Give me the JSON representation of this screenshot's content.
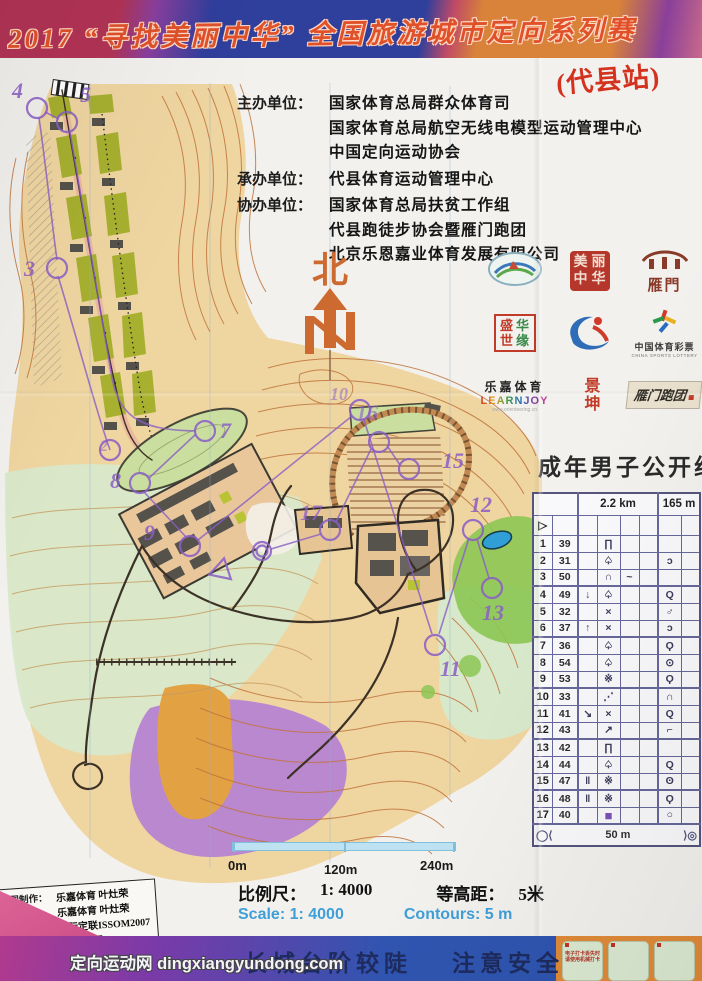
{
  "banner": {
    "title": "2017 “寻找美丽中华” 全国旅游城市定向系列赛"
  },
  "station": "(代县站)",
  "organizers": {
    "host_label": "主办单位：",
    "host_lines": [
      "国家体育总局群众体育司",
      "国家体育总局航空无线电模型运动管理中心",
      "中国定向运动协会"
    ],
    "undertaker_label": "承办单位：",
    "undertaker_lines": [
      "代县体育运动管理中心"
    ],
    "co_label": "协办单位：",
    "co_lines": [
      "国家体育总局扶贫工作组",
      "代县跑徒步协会暨雁门跑团",
      "北京乐恩嘉业体育发展有限公司"
    ]
  },
  "north": {
    "label": "北"
  },
  "logos": {
    "seal_chars": [
      "美",
      "丽",
      "中",
      "华"
    ],
    "gate_text": "雁門",
    "box4_chars": [
      "盛",
      "华",
      "世",
      "缘"
    ],
    "lottery_cn": "中国体育彩票",
    "lottery_en": "CHINA SPORTS LOTTERY",
    "lejia_cn": "乐嘉体育",
    "lejia_en": "LEARNJOY",
    "lejia_url": "www.orienteering.cn",
    "jingkun": "景坤",
    "yanmen_run": "雁门跑团"
  },
  "course": {
    "group_title": "成年男子公开组",
    "distance": "2.2 km",
    "climb": "165 m",
    "start_symbol": "▷",
    "rows": [
      {
        "no": "1",
        "code": "39",
        "c": "",
        "d": "∏",
        "e": "",
        "f": "",
        "g": "",
        "h": ""
      },
      {
        "no": "2",
        "code": "31",
        "c": "",
        "d": "♤",
        "e": "",
        "f": "",
        "g": "ɔ",
        "h": ""
      },
      {
        "no": "3",
        "code": "50",
        "c": "",
        "d": "∩",
        "e": "~",
        "f": "",
        "g": "",
        "h": ""
      },
      {
        "no": "4",
        "code": "49",
        "c": "↓",
        "d": "♤",
        "e": "",
        "f": "",
        "g": "Q",
        "h": ""
      },
      {
        "no": "5",
        "code": "32",
        "c": "",
        "d": "×",
        "e": "",
        "f": "",
        "g": "♂",
        "h": ""
      },
      {
        "no": "6",
        "code": "37",
        "c": "↑",
        "d": "×",
        "e": "",
        "f": "",
        "g": "ɔ",
        "h": ""
      },
      {
        "no": "7",
        "code": "36",
        "c": "",
        "d": "♤",
        "e": "",
        "f": "",
        "g": "Ϙ",
        "h": ""
      },
      {
        "no": "8",
        "code": "54",
        "c": "",
        "d": "♤",
        "e": "",
        "f": "",
        "g": "⊙",
        "h": ""
      },
      {
        "no": "9",
        "code": "53",
        "c": "",
        "d": "※",
        "e": "",
        "f": "",
        "g": "Ϙ",
        "h": ""
      },
      {
        "no": "10",
        "code": "33",
        "c": "",
        "d": "⋰",
        "e": "",
        "f": "",
        "g": "∩",
        "h": ""
      },
      {
        "no": "11",
        "code": "41",
        "c": "↘",
        "d": "×",
        "e": "",
        "f": "",
        "g": "Q",
        "h": ""
      },
      {
        "no": "12",
        "code": "43",
        "c": "",
        "d": "↗",
        "e": "",
        "f": "",
        "g": "⌐",
        "h": ""
      },
      {
        "no": "13",
        "code": "42",
        "c": "",
        "d": "∏",
        "e": "",
        "f": "",
        "g": "",
        "h": ""
      },
      {
        "no": "14",
        "code": "44",
        "c": "",
        "d": "♤",
        "e": "",
        "f": "",
        "g": "Q",
        "h": ""
      },
      {
        "no": "15",
        "code": "47",
        "c": "‖",
        "d": "※",
        "e": "",
        "f": "",
        "g": "ʘ",
        "h": ""
      },
      {
        "no": "16",
        "code": "48",
        "c": "‖",
        "d": "※",
        "e": "",
        "f": "",
        "g": "Ϙ",
        "h": ""
      },
      {
        "no": "17",
        "code": "40",
        "c": "",
        "d": "■",
        "e": "",
        "f": "",
        "g": "○",
        "h": ""
      }
    ],
    "finish_left": "◯⟨",
    "finish_distance": "50 m",
    "finish_right": "⟩◎"
  },
  "map": {
    "labels": {
      "c2": "2",
      "c3": "3",
      "c4": "4",
      "c5": "5",
      "c7": "7",
      "c8": "8",
      "c9": "9",
      "c10": "10",
      "c11": "11",
      "c12": "12",
      "c13": "13",
      "c15": "15",
      "c16": "16",
      "c17": "17"
    }
  },
  "scalebar": {
    "t0": "0m",
    "t1": "120m",
    "t2": "240m"
  },
  "scale_text": {
    "cn_scale_label": "比例尺：",
    "cn_scale_value": "1: 4000",
    "cn_contour_label": "等高距：",
    "cn_contour_value": "5米",
    "en_scale": "Scale:  1: 4000",
    "en_contour": "Contours: 5 m"
  },
  "credits": {
    "rows": [
      {
        "label": "地图制作：",
        "value": "乐嘉体育 叶灶荣"
      },
      {
        "label": "线路设计：",
        "value": "乐嘉体育 叶灶荣"
      },
      {
        "label": "执行标准：",
        "value": "国际定联ISSOM2007"
      },
      {
        "label": "制图时间：",
        "value": "2017年7月"
      },
      {
        "label": "底图提供：",
        "value": "代县体育局"
      }
    ]
  },
  "footer": {
    "safety1": "长城台阶较陡",
    "safety2": "注意安全",
    "watermark": "定向运动网 dingxiangyundong.com",
    "card_line1": "电子打卡丢失时",
    "card_line2": "请使用机械打卡"
  },
  "colors": {
    "course_purple": "#8a5ec6",
    "banner_blue": "#2f3f9c",
    "banner_red": "#b23355",
    "title_orange": "#e0512a",
    "station_red": "#d4321e",
    "map_tan": "#efd5a0",
    "map_olive": "#a7b02f",
    "map_green_light": "#d8e8ca",
    "map_green_bright": "#8cc653",
    "map_purple_area": "#b581d1",
    "scale_blue": "#3f9fd8"
  }
}
